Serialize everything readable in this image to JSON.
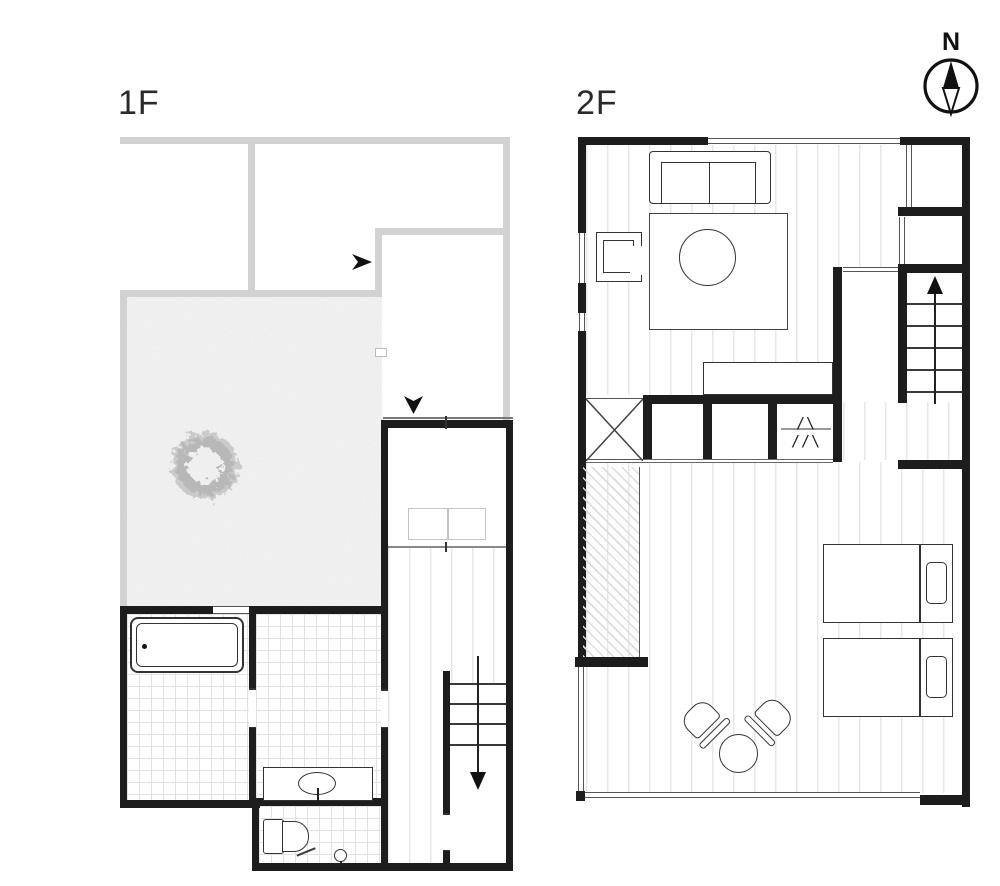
{
  "floor1": {
    "label": "1F"
  },
  "floor2": {
    "label": "2F"
  },
  "compass": {
    "label": "N"
  },
  "closet": {
    "hanger_marks": "/\\ //\\"
  },
  "colors": {
    "wall_black": "#1d1d1d",
    "wall_gray": "#d2d2d2",
    "line_dark": "#333333",
    "floor_line": "#e7e7e7",
    "tile_line": "#e2e2e2",
    "court_bg": "#f1f1f1",
    "accent_text": "#2a2a2a"
  }
}
